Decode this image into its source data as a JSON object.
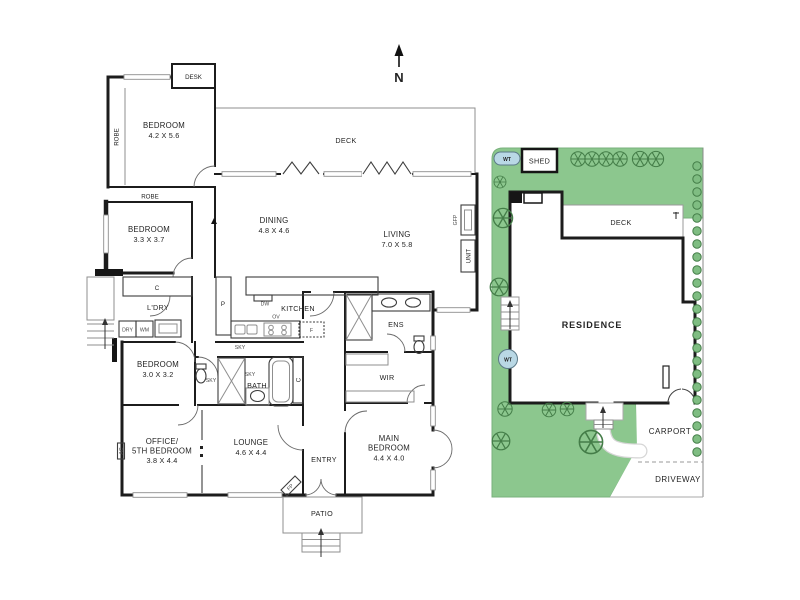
{
  "compass": {
    "north": "N"
  },
  "floorplan": {
    "rooms": {
      "bedroom1": {
        "name": "BEDROOM",
        "dims": "4.2 X 5.6"
      },
      "bedroom2": {
        "name": "BEDROOM",
        "dims": "3.3 X 3.7"
      },
      "bedroom3": {
        "name": "BEDROOM",
        "dims": "3.0 X 3.2"
      },
      "office": {
        "line1": "OFFICE/",
        "line2": "5TH BEDROOM",
        "dims": "3.8 X 4.4"
      },
      "lounge": {
        "name": "LOUNGE",
        "dims": "4.6 X 4.4"
      },
      "dining": {
        "name": "DINING",
        "dims": "4.8 X 4.6"
      },
      "living": {
        "name": "LIVING",
        "dims": "7.0 X 5.8"
      },
      "main_bedroom": {
        "line1": "MAIN",
        "line2": "BEDROOM",
        "dims": "4.4 X 4.0"
      },
      "kitchen": {
        "name": "KITCHEN"
      },
      "deck": {
        "name": "DECK"
      },
      "entry": {
        "name": "ENTRY"
      },
      "patio": {
        "name": "PATIO"
      },
      "bath": {
        "name": "BATH"
      },
      "ens": {
        "name": "ENS"
      },
      "wir": {
        "name": "WIR"
      },
      "laundry": {
        "name": "L'DRY"
      }
    },
    "fixtures": {
      "desk": "DESK",
      "robe": "ROBE",
      "cupboard": "C",
      "pantry": "P",
      "dishwasher": "DW",
      "oven": "OV",
      "fridge": "F",
      "dryer": "DRY",
      "washer": "WM",
      "skylight": "SKY",
      "aircon": "AC",
      "fireplace": "FP",
      "gas_fireplace": "GFP",
      "unit": "UNIT"
    }
  },
  "siteplan": {
    "labels": {
      "shed": "SHED",
      "water_tank": "WT",
      "deck": "DECK",
      "residence": "RESIDENCE",
      "carport": "CARPORT",
      "driveway": "DRIVEWAY"
    },
    "colors": {
      "grass": "#8cc78e",
      "tree": "#447d48",
      "water_tank_fill": "#b9d8e5"
    }
  }
}
